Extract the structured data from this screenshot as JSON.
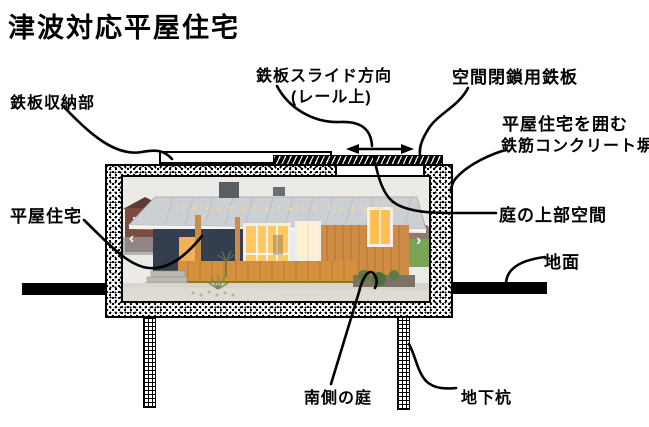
{
  "title": "津波対応平屋住宅",
  "labels": {
    "plate_storage": "鉄板収納部",
    "slide_direction_line1": "鉄板スライド方向",
    "slide_direction_line2": "(レール上)",
    "closure_plate": "空間閉鎖用鉄板",
    "fence_line1": "平屋住宅を囲む",
    "fence_line2": "鉄筋コンクリート塀",
    "house": "平屋住宅",
    "garden_upper_space": "庭の上部空間",
    "ground": "地面",
    "south_garden": "南側の庭",
    "underground_pile": "地下杭"
  },
  "photo": {
    "prev_icon": "‹",
    "next_icon": "›"
  },
  "colors": {
    "line": "#000000",
    "background": "#ffffff",
    "roof": "#cdd0d3",
    "navy_wall": "#343e4e",
    "wood_wall": "#cf8c44",
    "window_glow": "#ffc053",
    "grass": "#79a355"
  }
}
